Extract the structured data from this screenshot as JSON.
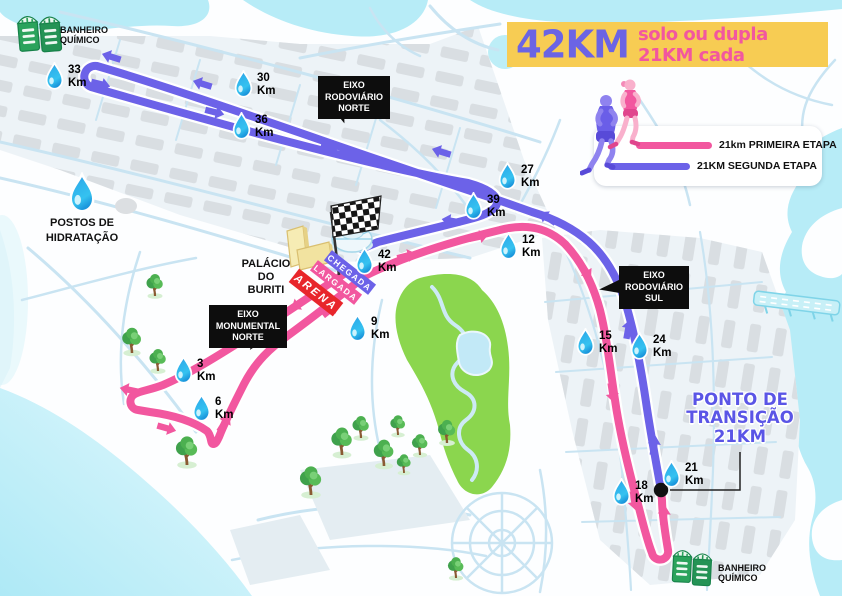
{
  "banner": {
    "big": "42KM",
    "rest": "solo ou dupla 21KM cada"
  },
  "legend": {
    "first": "21km PRIMEIRA ETAPA",
    "second": "21KM SEGUNDA ETAPA"
  },
  "callouts": {
    "rodoviario_norte": "EIXO\nRODOVIÁRIO\nNORTE",
    "rodoviario_sul": "EIXO\nRODOVIÁRIO\nSUL",
    "monumental_norte": "EIXO\nMONUMENTAL\nNORTE"
  },
  "labels": {
    "banheiro_top": "BANHEIRO\nQUÍMICO",
    "banheiro_bottom": "BANHEIRO\nQUÍMICO",
    "postos": "POSTOS DE\nHIDRATAÇÃO",
    "palacio": "PALÁCIO\nDO BURITI",
    "chegada": "CHEGADA",
    "largada": "LARGADA",
    "arena": "ARENA",
    "ponto": "PONTO DE\nTRANSIÇÃO\n21KM"
  },
  "markers": {
    "unit": "Km",
    "points": [
      {
        "km": "3"
      },
      {
        "km": "6"
      },
      {
        "km": "9"
      },
      {
        "km": "12"
      },
      {
        "km": "15"
      },
      {
        "km": "18"
      },
      {
        "km": "21"
      },
      {
        "km": "24"
      },
      {
        "km": "27"
      },
      {
        "km": "30"
      },
      {
        "km": "33"
      },
      {
        "km": "36"
      },
      {
        "km": "39"
      },
      {
        "km": "42"
      }
    ]
  },
  "colors": {
    "route_first_etapa": "#F2579F",
    "route_second_etapa": "#6C62E8",
    "banner_bg": "#F7CC53",
    "banner_42km": "#6B64E4",
    "banner_subtitle": "#F2579F",
    "water": "#B7ECF7",
    "park_green": "#8BD64E",
    "callout_bg": "#0D0D0D",
    "transition_text": "#5A55E6",
    "arena_red": "#E8262B",
    "toilet_green": "#2BA35C",
    "drop_blue": "#2BA9E8"
  }
}
